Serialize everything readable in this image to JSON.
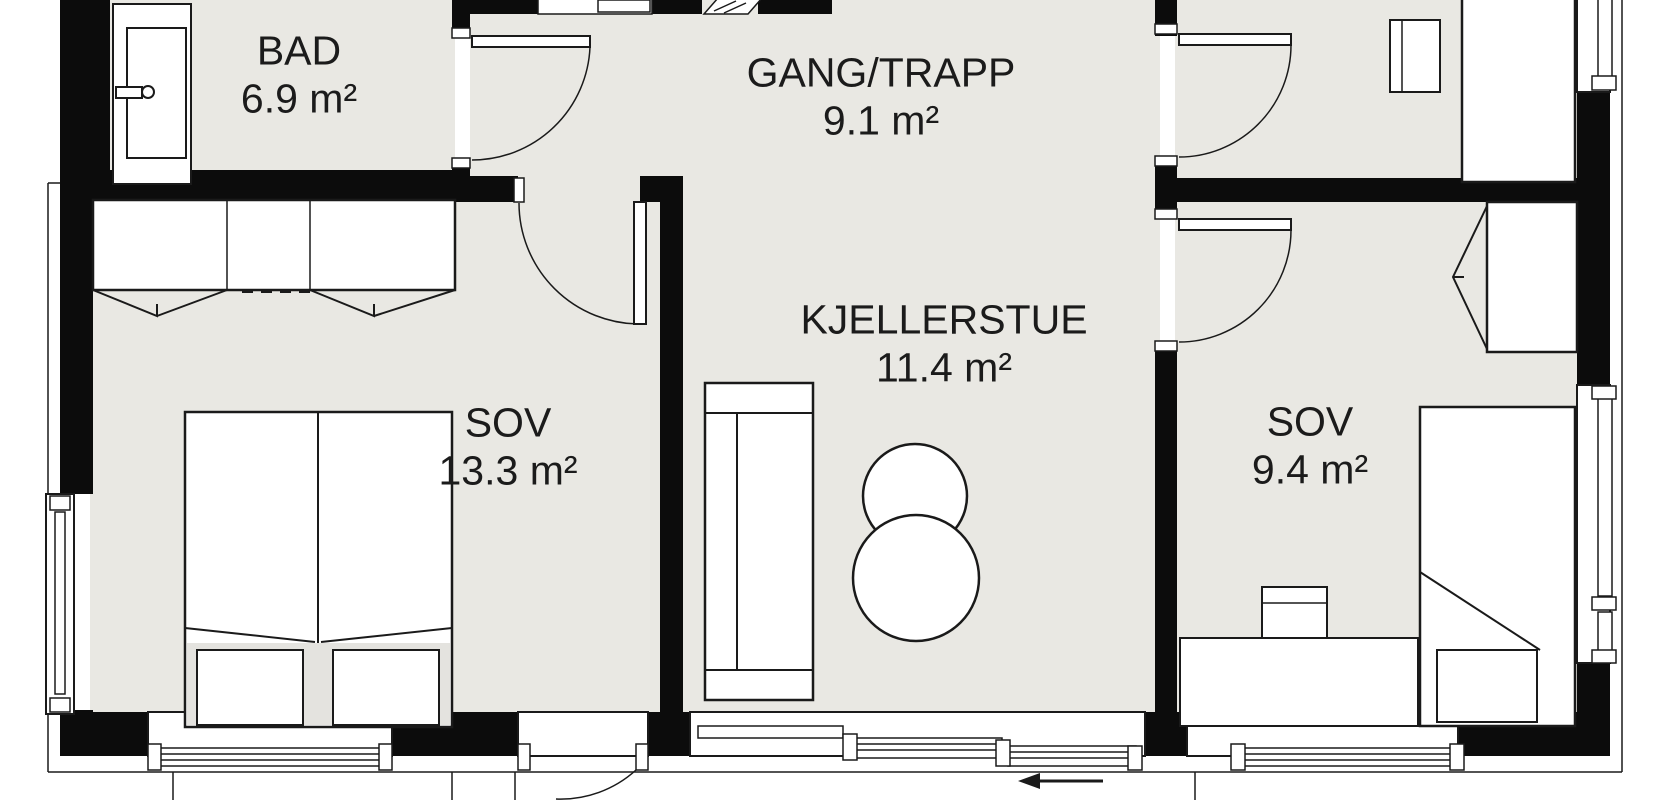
{
  "plan": {
    "rooms": [
      {
        "name": "BAD",
        "area": "6.9 m²"
      },
      {
        "name": "GANG/TRAPP",
        "area": "9.1 m²"
      },
      {
        "name": "KJELLERSTUE",
        "area": "11.4 m²"
      },
      {
        "name": "SOV",
        "area": "13.3 m²"
      },
      {
        "name": "SOV",
        "area": "9.4 m²"
      }
    ],
    "colors": {
      "wall": "#0c0c0c",
      "room_fill": "#e9e8e3",
      "exterior": "#ffffff",
      "outline": "#1a1a1a",
      "text": "#1b1b1b"
    },
    "furniture": {
      "bad": [
        "vanity-sink"
      ],
      "sov_13_3": [
        "double-wardrobe",
        "double-bed"
      ],
      "kjellerstue": [
        "sofa",
        "round-side-table",
        "round-side-table"
      ],
      "sov_9_4": [
        "wardrobe",
        "chair",
        "dresser",
        "single-bed"
      ],
      "upper_right_room": [
        "desk",
        "chair"
      ]
    },
    "annotations": {
      "sliding_door_direction": "left"
    }
  }
}
